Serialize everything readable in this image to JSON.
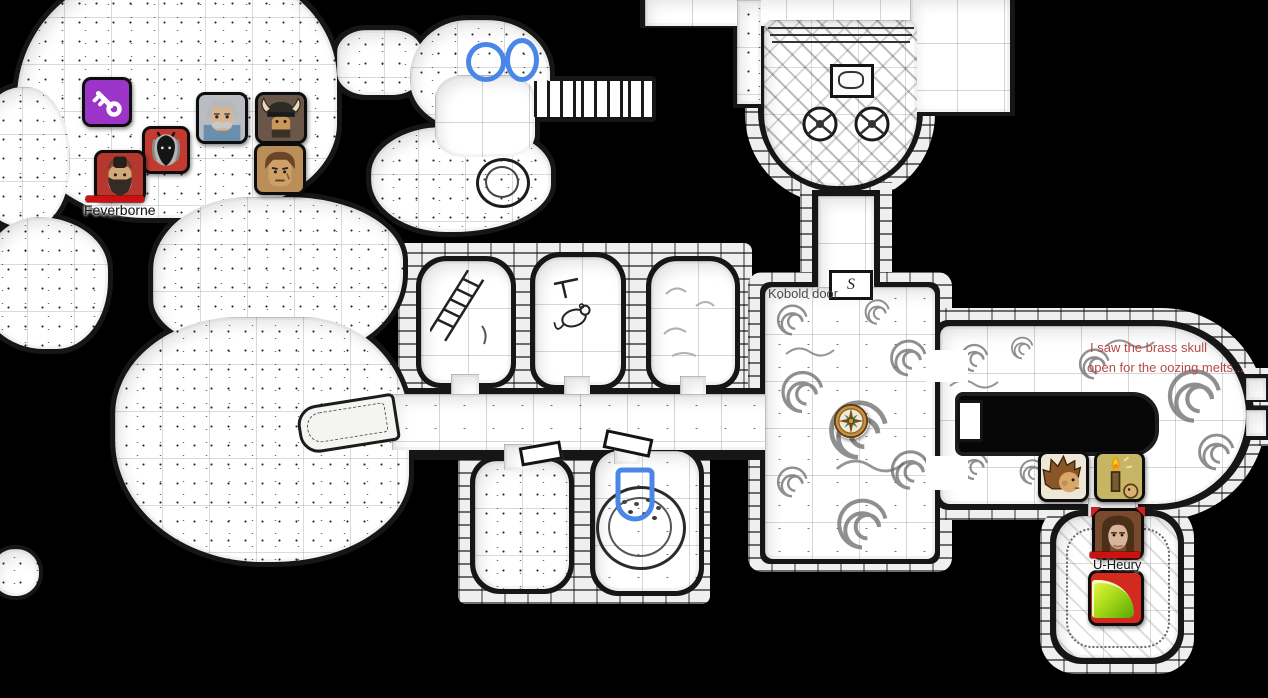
{
  "scene": {
    "background": "#000000",
    "description": "hand-drawn dungeon battle map floating on black void, square grid"
  },
  "map": {
    "grid_color": "rgba(0,0,0,0.16)",
    "ink_color": "#161616",
    "labels": {
      "kobold_door": "Kobold door",
      "door_glyph": "S"
    },
    "note": {
      "line1": "I saw the brass skull",
      "line2": "open for the oozing melts...",
      "color": "#b84848"
    }
  },
  "annotations": {
    "color": "#4a86e8"
  },
  "tokens": {
    "purple_key": {
      "icon": "key-icon",
      "bg": "#9a35c8"
    },
    "demon": {
      "icon": "demon-face-icon",
      "bg": "#c23a30"
    },
    "elder": {
      "icon": "elder-portrait-icon",
      "bg": "#b9bdc2"
    },
    "viking": {
      "icon": "horned-helmet-portrait-icon",
      "bg": "#6b564a"
    },
    "rugged": {
      "icon": "rugged-man-portrait-icon",
      "bg": "#b98e58"
    },
    "feverborne": {
      "label": "Feverborne",
      "icon": "bearded-man-portrait-icon",
      "bg": "#b5372e",
      "hp_color": "#cc1111"
    },
    "spiky": {
      "icon": "spiky-hair-portrait-icon",
      "bg": "#efe7d6"
    },
    "candle": {
      "icon": "candle-portrait-icon",
      "bg": "#cfc068"
    },
    "u_heury": {
      "label": "U-Heury",
      "icon": "long-haired-portrait-icon",
      "bg": "#7a4a2e",
      "hp_color": "#cc1111"
    },
    "ooze": {
      "icon": "green-ooze-icon",
      "bg": "#d42a1e"
    },
    "compass": {
      "icon": "compass-rose-icon",
      "bg": "#f2e9d2",
      "ring": "#c89040"
    }
  }
}
